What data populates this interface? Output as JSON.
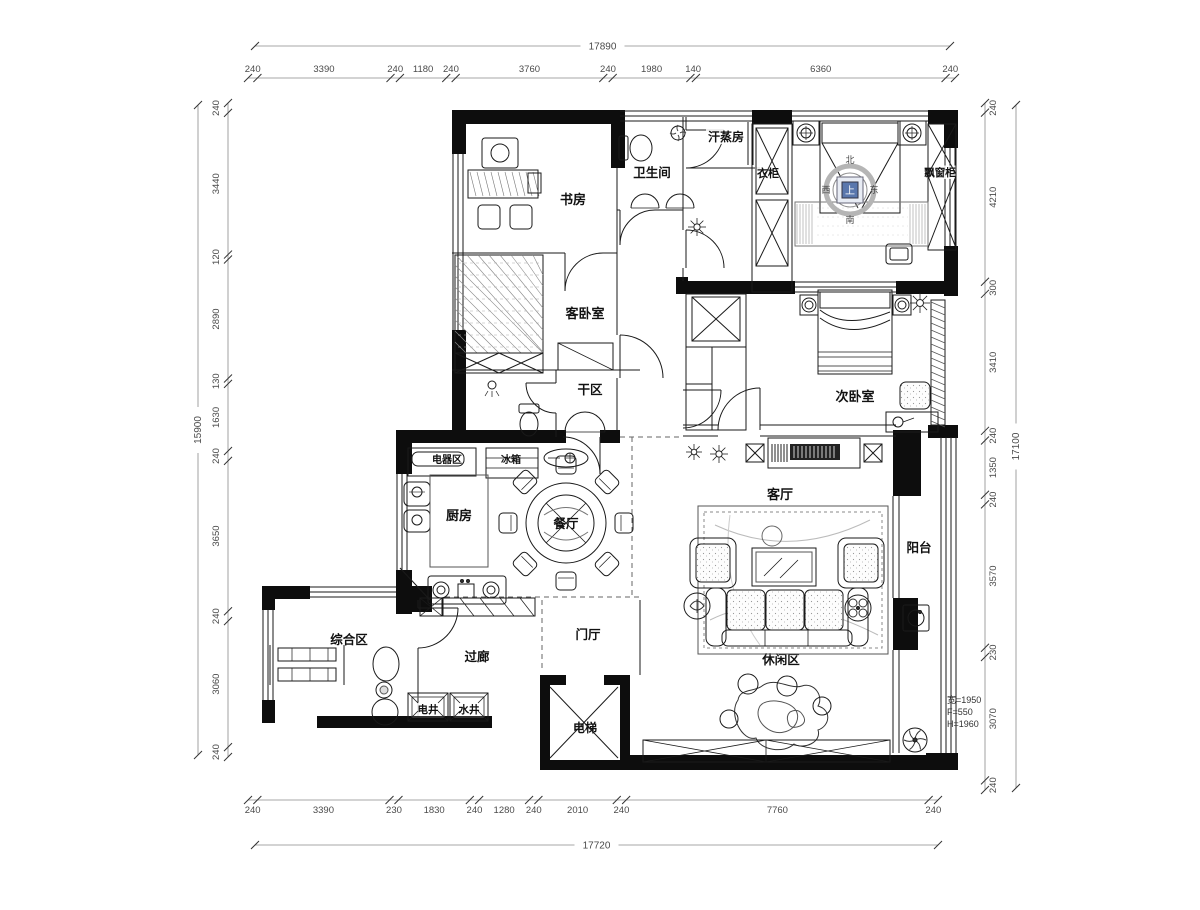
{
  "drawing": {
    "type": "residential-floor-plan",
    "rooms": [
      {
        "id": "study",
        "label": "书房"
      },
      {
        "id": "bathroom",
        "label": "卫生间"
      },
      {
        "id": "sauna",
        "label": "汗蒸房"
      },
      {
        "id": "wardrobe",
        "label": "衣柜"
      },
      {
        "id": "bay_cabinet",
        "label": "飘窗柜"
      },
      {
        "id": "guest_bedroom",
        "label": "客卧室"
      },
      {
        "id": "dry_area",
        "label": "干区"
      },
      {
        "id": "second_bedroom",
        "label": "次卧室"
      },
      {
        "id": "appliance_area",
        "label": "电器区"
      },
      {
        "id": "fridge",
        "label": "冰箱"
      },
      {
        "id": "kitchen",
        "label": "厨房"
      },
      {
        "id": "dining",
        "label": "餐厅"
      },
      {
        "id": "living",
        "label": "客厅"
      },
      {
        "id": "balcony",
        "label": "阳台"
      },
      {
        "id": "multi_area",
        "label": "综合区"
      },
      {
        "id": "corridor",
        "label": "过廊"
      },
      {
        "id": "foyer",
        "label": "门厅"
      },
      {
        "id": "leisure",
        "label": "休闲区"
      },
      {
        "id": "elec_shaft",
        "label": "电井"
      },
      {
        "id": "water_shaft",
        "label": "水井"
      },
      {
        "id": "elevator",
        "label": "电梯"
      }
    ],
    "compass": {
      "north": "北",
      "south": "南",
      "west": "西",
      "east": "东",
      "center": "上"
    },
    "window_note": {
      "line1": "宽=1950",
      "line2": "F=550",
      "line3": "H=1960"
    },
    "dimensions": {
      "top": {
        "total": "17890",
        "segments": [
          "240",
          "3390",
          "240",
          "1180",
          "240",
          "3760",
          "240",
          "1980",
          "140",
          "6360",
          "240"
        ]
      },
      "bottom": {
        "total": "17720",
        "segments": [
          "240",
          "3390",
          "230",
          "1830",
          "240",
          "1280",
          "240",
          "2010",
          "240",
          "7760",
          "240"
        ]
      },
      "left": {
        "total": "15900",
        "segments": [
          "240",
          "3440",
          "120",
          "2890",
          "130",
          "1630",
          "240",
          "3650",
          "240",
          "3060",
          "240"
        ]
      },
      "right": {
        "total": "17100",
        "segments": [
          "240",
          "4210",
          "300",
          "3410",
          "240",
          "1350",
          "240",
          "3570",
          "230",
          "3070",
          "240"
        ]
      }
    },
    "colors": {
      "wall": "#0d0d0d",
      "line": "#1a1a1a",
      "dim": "#8a8a8a",
      "dim_text": "#4a4a4a",
      "compass_fill": "#5a77ad"
    }
  }
}
